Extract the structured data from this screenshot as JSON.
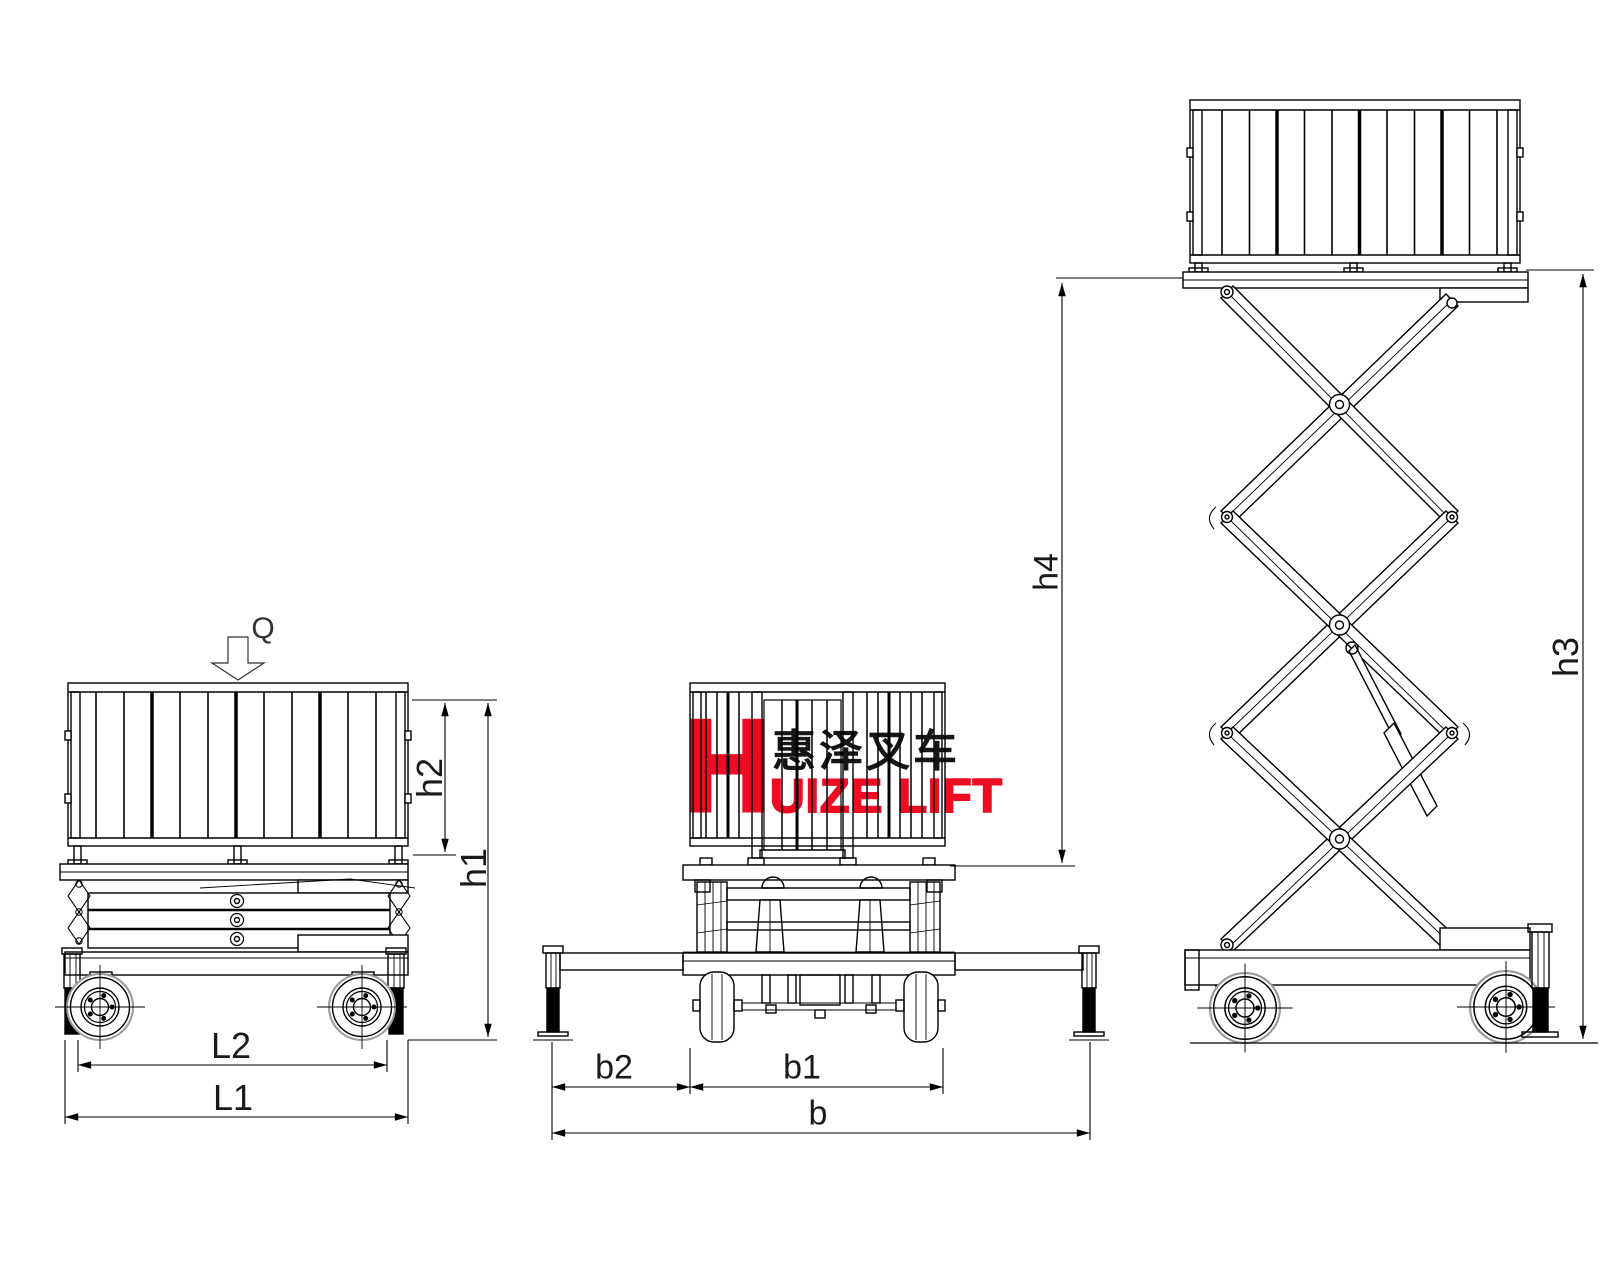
{
  "drawing": {
    "description": "Three-view outline drawing of a mobile scissor lift: side view lowered, front view lowered, side view raised",
    "load_label": "Q",
    "dimensions": {
      "L1": "L1",
      "L2": "L2",
      "h1": "h1",
      "h2": "h2",
      "b": "b",
      "b1": "b1",
      "b2": "b2",
      "h3": "h3",
      "h4": "h4"
    },
    "logo": {
      "initial": "H",
      "cjk": "惠泽叉车",
      "latin": "UIZE LIFT"
    },
    "colors": {
      "line": "#000000",
      "accent_red": "#ee0c22",
      "secondary_gray": "#999999",
      "background": "#ffffff"
    }
  }
}
